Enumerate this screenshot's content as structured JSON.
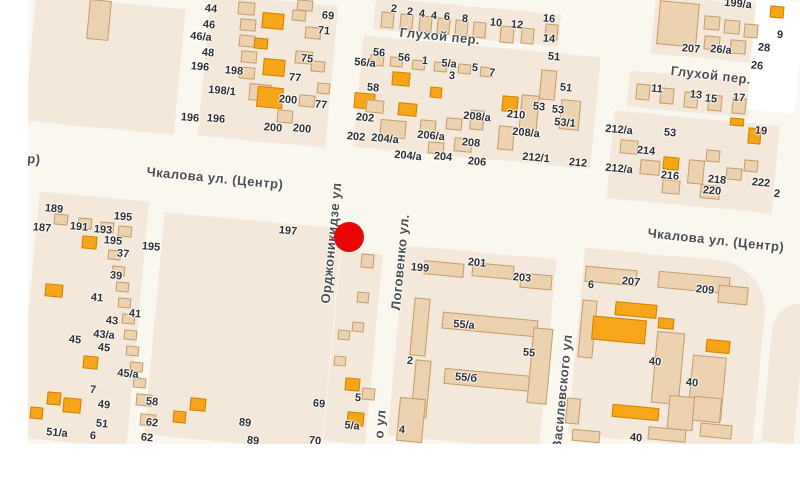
{
  "map": {
    "marker": {
      "x": 349,
      "y": 237,
      "d": 30,
      "color": "#e80505"
    },
    "colors": {
      "street": "#faf7ef",
      "block": "#f4e8da",
      "building": "#ecd2af",
      "building_border": "#c59c6b",
      "orange_building": "#f7a519",
      "orange_border": "#cd8303",
      "label_text": "#2d2d2d",
      "street_text": "#4d4d4d"
    },
    "street_labels": [
      {
        "text": "Чкалова ул. (Центр)",
        "x": 215,
        "y": 178,
        "rot": 5.5
      },
      {
        "text": "Чкалова ул. (Центр)",
        "x": 716,
        "y": 240,
        "rot": 6
      },
      {
        "text": "Глухой пер.",
        "x": 440,
        "y": 36,
        "rot": 5.5
      },
      {
        "text": "Глухой пер.",
        "x": 711,
        "y": 75,
        "rot": 6.5
      },
      {
        "text": "Орджоникидзе ул",
        "x": 331,
        "y": 243,
        "rot": -84.5
      },
      {
        "text": "Логовенко ул.",
        "x": 400,
        "y": 262,
        "rot": -84.5
      },
      {
        "text": "о ул",
        "x": 380,
        "y": 424,
        "rot": -84.5
      },
      {
        "text": "Василевского ул",
        "x": 562,
        "y": 392,
        "rot": -84.5
      },
      {
        "text": "р)",
        "x": 34,
        "y": 159,
        "rot": 5
      }
    ],
    "house_numbers": [
      [
        "44",
        211,
        9
      ],
      [
        "46",
        209,
        25
      ],
      [
        "46/а",
        201,
        37
      ],
      [
        "48",
        208,
        53
      ],
      [
        "196",
        200,
        67
      ],
      [
        "198",
        234,
        71
      ],
      [
        "198/1",
        222,
        91
      ],
      [
        "196",
        190,
        118
      ],
      [
        "196",
        216,
        119
      ],
      [
        "69",
        328,
        16
      ],
      [
        "71",
        324,
        31
      ],
      [
        "75",
        307,
        59
      ],
      [
        "77",
        295,
        78
      ],
      [
        "200",
        288,
        100
      ],
      [
        "77",
        321,
        105
      ],
      [
        "200",
        273,
        128
      ],
      [
        "200",
        302,
        129
      ],
      [
        "2",
        394,
        9
      ],
      [
        "2",
        410,
        12
      ],
      [
        "4",
        422,
        14
      ],
      [
        "4",
        434,
        16
      ],
      [
        "6",
        447,
        17
      ],
      [
        "8",
        465,
        19
      ],
      [
        "10",
        496,
        23
      ],
      [
        "12",
        517,
        25
      ],
      [
        "16",
        549,
        19
      ],
      [
        "14",
        549,
        39
      ],
      [
        "56",
        379,
        53
      ],
      [
        "56",
        404,
        58
      ],
      [
        "1",
        425,
        61
      ],
      [
        "5/а",
        449,
        64
      ],
      [
        "3",
        452,
        76
      ],
      [
        "5",
        475,
        68
      ],
      [
        "7",
        492,
        73
      ],
      [
        "56/а",
        365,
        63
      ],
      [
        "58",
        373,
        88
      ],
      [
        "51",
        554,
        57
      ],
      [
        "202",
        365,
        118
      ],
      [
        "202",
        356,
        137
      ],
      [
        "204/а",
        385,
        139
      ],
      [
        "206/а",
        431,
        136
      ],
      [
        "204/а",
        408,
        156
      ],
      [
        "204",
        443,
        157
      ],
      [
        "208/а",
        477,
        117
      ],
      [
        "208",
        471,
        143
      ],
      [
        "206",
        477,
        162
      ],
      [
        "210",
        516,
        115
      ],
      [
        "53",
        539,
        107
      ],
      [
        "53",
        558,
        110
      ],
      [
        "208/а",
        526,
        133
      ],
      [
        "212/1",
        536,
        158
      ],
      [
        "51",
        566,
        88
      ],
      [
        "53/1",
        565,
        123
      ],
      [
        "212",
        578,
        163
      ],
      [
        "212/а",
        619,
        130
      ],
      [
        "212/а",
        619,
        169
      ],
      [
        "214",
        646,
        151
      ],
      [
        "216",
        670,
        176
      ],
      [
        "218",
        717,
        180
      ],
      [
        "220",
        712,
        191
      ],
      [
        "222",
        761,
        183
      ],
      [
        "2",
        777,
        194
      ],
      [
        "19",
        761,
        131
      ],
      [
        "53",
        670,
        133
      ],
      [
        "11",
        657,
        89
      ],
      [
        "13",
        696,
        95
      ],
      [
        "15",
        711,
        99
      ],
      [
        "17",
        739,
        98
      ],
      [
        "199/а",
        738,
        4
      ],
      [
        "207",
        691,
        49
      ],
      [
        "26/а",
        721,
        50
      ],
      [
        "28",
        764,
        48
      ],
      [
        "26",
        757,
        66
      ],
      [
        "9",
        780,
        35
      ],
      [
        "189",
        54,
        209
      ],
      [
        "187",
        42,
        228
      ],
      [
        "191",
        79,
        227
      ],
      [
        "193",
        103,
        230
      ],
      [
        "195",
        123,
        217
      ],
      [
        "195",
        113,
        241
      ],
      [
        "195",
        151,
        247
      ],
      [
        "37",
        123,
        254
      ],
      [
        "39",
        116,
        276
      ],
      [
        "41",
        97,
        298
      ],
      [
        "41",
        135,
        314
      ],
      [
        "43",
        112,
        321
      ],
      [
        "43/а",
        104,
        335
      ],
      [
        "45",
        75,
        340
      ],
      [
        "45",
        104,
        348
      ],
      [
        "45/а",
        128,
        374
      ],
      [
        "7",
        93,
        390
      ],
      [
        "49",
        104,
        405
      ],
      [
        "51",
        102,
        424
      ],
      [
        "51/а",
        57,
        433
      ],
      [
        "6",
        93,
        436
      ],
      [
        "58",
        152,
        402
      ],
      [
        "62",
        152,
        423
      ],
      [
        "62",
        147,
        438
      ],
      [
        "89",
        245,
        423
      ],
      [
        "89",
        253,
        441
      ],
      [
        "197",
        288,
        231
      ],
      [
        "69",
        319,
        404
      ],
      [
        "5",
        358,
        398
      ],
      [
        "5/а",
        352,
        426
      ],
      [
        "70",
        315,
        441
      ],
      [
        "4",
        402,
        430
      ],
      [
        "199",
        420,
        268
      ],
      [
        "201",
        477,
        263
      ],
      [
        "203",
        522,
        278
      ],
      [
        "55/а",
        464,
        325
      ],
      [
        "55",
        529,
        353
      ],
      [
        "55/б",
        466,
        378
      ],
      [
        "2",
        410,
        361
      ],
      [
        "6",
        591,
        285
      ],
      [
        "207",
        631,
        282
      ],
      [
        "209",
        705,
        290
      ],
      [
        "40",
        655,
        362
      ],
      [
        "40",
        692,
        383
      ],
      [
        "40",
        636,
        438
      ]
    ],
    "blocks": [
      {
        "x": 30,
        "y": 2,
        "w": 150,
        "h": 126
      },
      {
        "x": 204,
        "y": 0,
        "w": 128,
        "h": 142
      },
      {
        "x": 374,
        "y": 6,
        "w": 186,
        "h": 32
      },
      {
        "x": 358,
        "y": 46,
        "w": 238,
        "h": 112
      },
      {
        "x": 610,
        "y": 118,
        "w": 166,
        "h": 88
      },
      {
        "x": 628,
        "y": 76,
        "w": 122,
        "h": 36
      },
      {
        "x": 653,
        "y": 0,
        "w": 100,
        "h": 58
      },
      {
        "x": 28,
        "y": 196,
        "w": 110,
        "h": 247
      },
      {
        "x": 154,
        "y": 220,
        "w": 178,
        "h": 223
      },
      {
        "x": 332,
        "y": 252,
        "w": 42,
        "h": 191
      },
      {
        "x": 396,
        "y": 252,
        "w": 152,
        "h": 191
      },
      {
        "x": 576,
        "y": 256,
        "w": 185,
        "h": 187,
        "rtr": 50
      },
      {
        "x": 768,
        "y": 302,
        "w": 32,
        "h": 141,
        "rtl": 30
      }
    ],
    "masks": [
      {
        "x": 752,
        "y": 0,
        "w": 48,
        "h": 112
      }
    ],
    "buildings": [
      [
        88,
        0,
        22,
        40,
        "b"
      ],
      [
        238,
        2,
        17,
        13,
        "b"
      ],
      [
        240,
        19,
        16,
        12,
        "b"
      ],
      [
        239,
        35,
        16,
        12,
        "b"
      ],
      [
        241,
        51,
        16,
        12,
        "b"
      ],
      [
        239,
        67,
        16,
        12,
        "b"
      ],
      [
        249,
        84,
        22,
        17,
        "b"
      ],
      [
        262,
        13,
        22,
        16,
        "o"
      ],
      [
        254,
        38,
        14,
        11,
        "o"
      ],
      [
        263,
        59,
        22,
        17,
        "o"
      ],
      [
        257,
        87,
        26,
        21,
        "o"
      ],
      [
        297,
        0,
        16,
        11,
        "b"
      ],
      [
        305,
        27,
        16,
        12,
        "b"
      ],
      [
        295,
        51,
        18,
        13,
        "b"
      ],
      [
        311,
        61,
        14,
        11,
        "b"
      ],
      [
        277,
        110,
        16,
        13,
        "b"
      ],
      [
        299,
        95,
        16,
        12,
        "b"
      ],
      [
        317,
        83,
        13,
        11,
        "b"
      ],
      [
        292,
        10,
        14,
        11,
        "b"
      ],
      [
        381,
        12,
        13,
        16,
        "b"
      ],
      [
        400,
        14,
        13,
        16,
        "b"
      ],
      [
        419,
        16,
        13,
        16,
        "b"
      ],
      [
        437,
        18,
        13,
        16,
        "b"
      ],
      [
        455,
        20,
        13,
        16,
        "b"
      ],
      [
        473,
        22,
        13,
        16,
        "b"
      ],
      [
        500,
        26,
        14,
        17,
        "b"
      ],
      [
        521,
        28,
        13,
        16,
        "b"
      ],
      [
        545,
        24,
        13,
        16,
        "b"
      ],
      [
        392,
        72,
        18,
        14,
        "o"
      ],
      [
        354,
        93,
        21,
        16,
        "o"
      ],
      [
        398,
        103,
        19,
        13,
        "o"
      ],
      [
        430,
        87,
        12,
        11,
        "o"
      ],
      [
        502,
        96,
        16,
        16,
        "o"
      ],
      [
        370,
        55,
        14,
        11,
        "b"
      ],
      [
        390,
        57,
        13,
        10,
        "b"
      ],
      [
        412,
        60,
        13,
        10,
        "b"
      ],
      [
        434,
        62,
        13,
        10,
        "b"
      ],
      [
        458,
        64,
        13,
        10,
        "b"
      ],
      [
        480,
        67,
        13,
        10,
        "b"
      ],
      [
        366,
        100,
        18,
        13,
        "b"
      ],
      [
        380,
        120,
        26,
        18,
        "b"
      ],
      [
        420,
        120,
        16,
        12,
        "b"
      ],
      [
        446,
        118,
        16,
        12,
        "b"
      ],
      [
        470,
        110,
        14,
        20,
        "b"
      ],
      [
        498,
        126,
        16,
        24,
        "b"
      ],
      [
        520,
        95,
        18,
        40,
        "b"
      ],
      [
        540,
        70,
        16,
        30,
        "b"
      ],
      [
        560,
        100,
        20,
        30,
        "b"
      ],
      [
        454,
        138,
        18,
        14,
        "b"
      ],
      [
        428,
        142,
        16,
        12,
        "b"
      ],
      [
        620,
        140,
        18,
        14,
        "b"
      ],
      [
        640,
        160,
        20,
        15,
        "b"
      ],
      [
        662,
        180,
        18,
        14,
        "b"
      ],
      [
        688,
        160,
        16,
        24,
        "b"
      ],
      [
        706,
        150,
        14,
        12,
        "b"
      ],
      [
        730,
        118,
        14,
        8,
        "o"
      ],
      [
        748,
        128,
        13,
        16,
        "o"
      ],
      [
        663,
        157,
        16,
        13,
        "o"
      ],
      [
        700,
        185,
        20,
        14,
        "b"
      ],
      [
        726,
        168,
        16,
        12,
        "b"
      ],
      [
        744,
        160,
        14,
        12,
        "b"
      ],
      [
        636,
        84,
        14,
        16,
        "b"
      ],
      [
        660,
        88,
        14,
        16,
        "b"
      ],
      [
        684,
        92,
        14,
        16,
        "b"
      ],
      [
        708,
        95,
        14,
        16,
        "b"
      ],
      [
        732,
        98,
        14,
        16,
        "b"
      ],
      [
        658,
        2,
        40,
        44,
        "b"
      ],
      [
        704,
        16,
        16,
        14,
        "b"
      ],
      [
        724,
        20,
        16,
        14,
        "b"
      ],
      [
        744,
        24,
        14,
        14,
        "b"
      ],
      [
        704,
        36,
        16,
        14,
        "b"
      ],
      [
        730,
        40,
        16,
        14,
        "b"
      ],
      [
        770,
        6,
        14,
        12,
        "o"
      ],
      [
        82,
        236,
        15,
        13,
        "o"
      ],
      [
        45,
        284,
        18,
        13,
        "o"
      ],
      [
        83,
        356,
        15,
        13,
        "o"
      ],
      [
        47,
        392,
        14,
        13,
        "o"
      ],
      [
        30,
        407,
        13,
        12,
        "o"
      ],
      [
        63,
        398,
        18,
        15,
        "o"
      ],
      [
        54,
        214,
        14,
        11,
        "b"
      ],
      [
        78,
        218,
        14,
        11,
        "b"
      ],
      [
        100,
        222,
        14,
        11,
        "b"
      ],
      [
        118,
        226,
        14,
        11,
        "b"
      ],
      [
        108,
        250,
        13,
        10,
        "b"
      ],
      [
        112,
        266,
        13,
        10,
        "b"
      ],
      [
        116,
        282,
        13,
        10,
        "b"
      ],
      [
        118,
        298,
        13,
        10,
        "b"
      ],
      [
        122,
        314,
        13,
        10,
        "b"
      ],
      [
        124,
        330,
        13,
        10,
        "b"
      ],
      [
        126,
        346,
        13,
        10,
        "b"
      ],
      [
        130,
        362,
        13,
        10,
        "b"
      ],
      [
        133,
        378,
        13,
        10,
        "b"
      ],
      [
        136,
        394,
        16,
        12,
        "b"
      ],
      [
        140,
        414,
        16,
        12,
        "b"
      ],
      [
        190,
        398,
        16,
        13,
        "o"
      ],
      [
        173,
        411,
        13,
        12,
        "o"
      ],
      [
        361,
        254,
        13,
        14,
        "b"
      ],
      [
        357,
        292,
        12,
        11,
        "b"
      ],
      [
        352,
        322,
        12,
        10,
        "b"
      ],
      [
        345,
        378,
        15,
        13,
        "o"
      ],
      [
        347,
        412,
        17,
        14,
        "o"
      ],
      [
        362,
        388,
        13,
        12,
        "b"
      ],
      [
        338,
        330,
        12,
        10,
        "b"
      ],
      [
        334,
        356,
        12,
        10,
        "b"
      ],
      [
        424,
        262,
        40,
        14,
        "b"
      ],
      [
        472,
        264,
        42,
        14,
        "b"
      ],
      [
        520,
        274,
        32,
        15,
        "b"
      ],
      [
        412,
        298,
        16,
        58,
        "b"
      ],
      [
        413,
        360,
        16,
        58,
        "b"
      ],
      [
        442,
        316,
        96,
        17,
        "b"
      ],
      [
        444,
        372,
        90,
        16,
        "b"
      ],
      [
        530,
        328,
        20,
        76,
        "b"
      ],
      [
        398,
        398,
        26,
        44,
        "b"
      ],
      [
        585,
        268,
        52,
        16,
        "b"
      ],
      [
        658,
        274,
        72,
        17,
        "b"
      ],
      [
        580,
        300,
        15,
        58,
        "b"
      ],
      [
        615,
        303,
        42,
        14,
        "o"
      ],
      [
        592,
        318,
        54,
        24,
        "o"
      ],
      [
        658,
        318,
        16,
        11,
        "o"
      ],
      [
        706,
        340,
        24,
        13,
        "o"
      ],
      [
        654,
        332,
        28,
        72,
        "b"
      ],
      [
        690,
        356,
        34,
        64,
        "b"
      ],
      [
        718,
        286,
        30,
        18,
        "b"
      ],
      [
        612,
        406,
        47,
        13,
        "o"
      ],
      [
        566,
        398,
        14,
        26,
        "b"
      ],
      [
        572,
        430,
        28,
        12,
        "b"
      ],
      [
        648,
        428,
        38,
        13,
        "b"
      ],
      [
        700,
        424,
        32,
        14,
        "b"
      ],
      [
        668,
        396,
        26,
        34,
        "b"
      ],
      [
        693,
        397,
        28,
        25,
        "b"
      ]
    ]
  }
}
